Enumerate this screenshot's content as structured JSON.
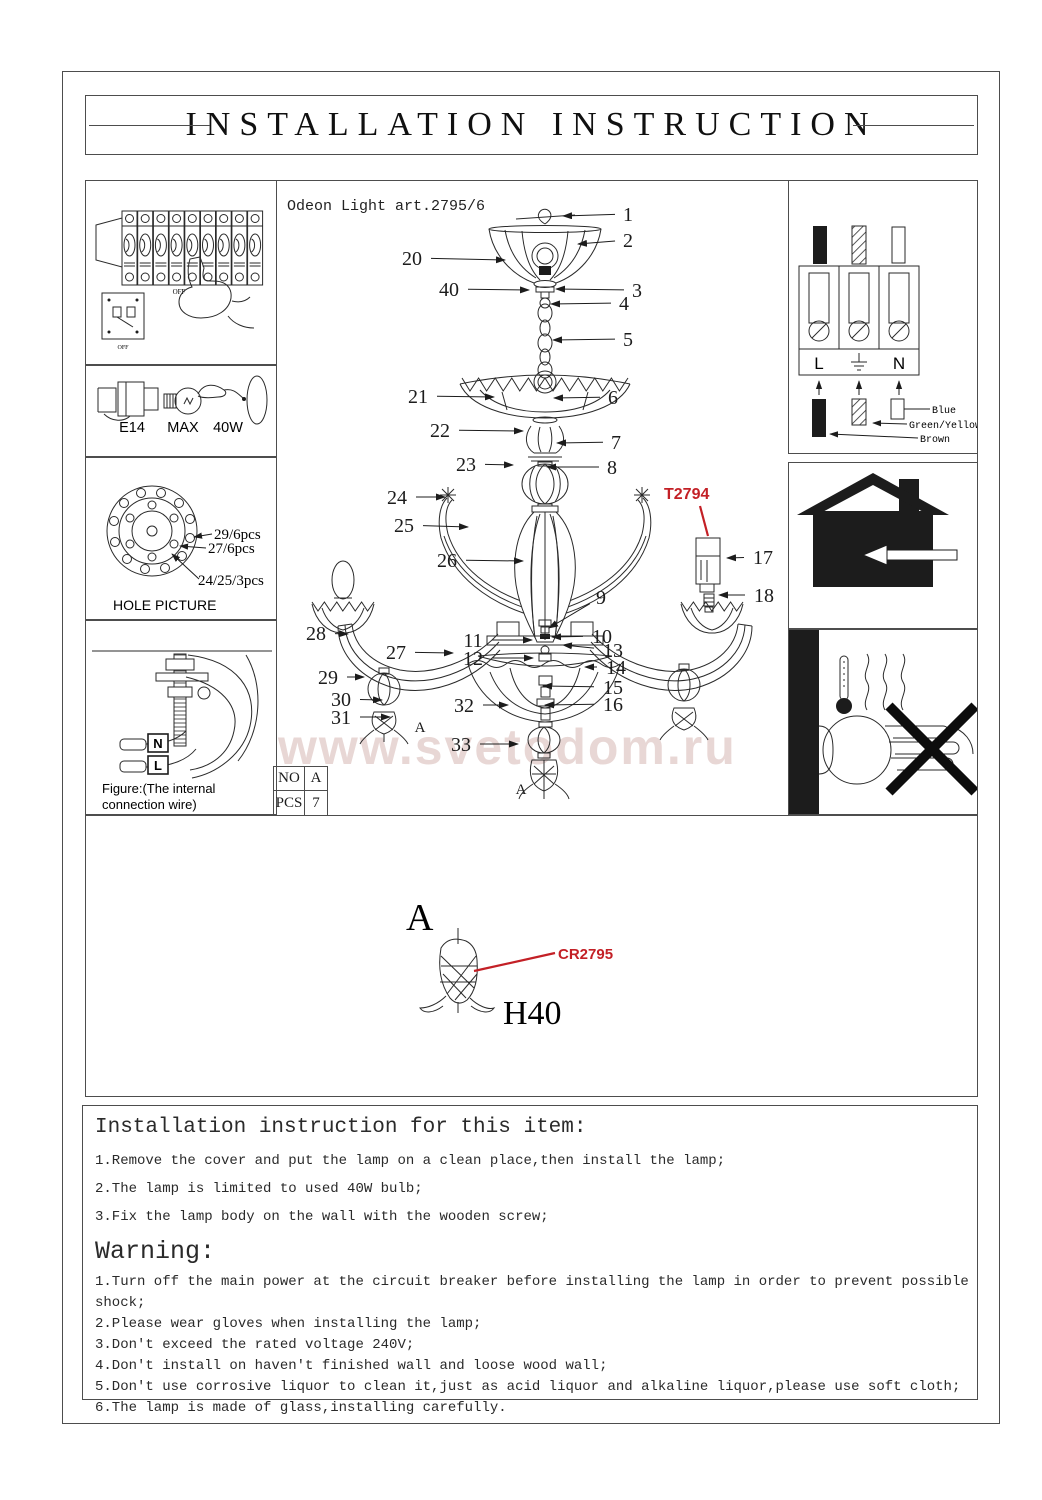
{
  "title": "INSTALLATION INSTRUCTION",
  "product_code": "Odeon Light art.2795/6",
  "watermark": "www.svetodom.ru",
  "colors": {
    "accent_red": "#c32026",
    "watermark_pink": "#e8d7d5"
  },
  "left_panels": {
    "breaker": {
      "off_top": "OFF",
      "off_bottom": "OFF"
    },
    "bulb": {
      "socket": "E14",
      "max_label": "MAX",
      "wattage": "40W"
    },
    "hole": {
      "title": "HOLE PICTURE",
      "callouts": [
        "29/6pcs",
        "27/6pcs",
        "24/25/3pcs"
      ]
    },
    "wire": {
      "n_label": "N",
      "l_label": "L",
      "caption_line1": "Figure:(The internal",
      "caption_line2": "connection wire)"
    }
  },
  "right_panels": {
    "terminal": {
      "live": "L",
      "neutral": "N",
      "wire_labels": [
        "Blue",
        "Green/Yellow",
        "Brown"
      ]
    }
  },
  "diagram": {
    "red_code": "T2794",
    "table": {
      "r1c1": "NO",
      "r1c2": "A",
      "r2c1": "PCS",
      "r2c2": "7"
    },
    "tag_left_arm": "A",
    "tag_bottom": "A",
    "detail": {
      "letter": "A",
      "code": "CR2795",
      "size": "H40"
    },
    "part_labels": [
      {
        "t": "1",
        "lx": 628,
        "ly": 214,
        "tx": 563,
        "ty": 216
      },
      {
        "t": "2",
        "lx": 628,
        "ly": 240,
        "tx": 578,
        "ty": 244
      },
      {
        "t": "20",
        "lx": 412,
        "ly": 258,
        "tx": 505,
        "ty": 260
      },
      {
        "t": "40",
        "lx": 449,
        "ly": 289,
        "tx": 529,
        "ty": 290
      },
      {
        "t": "3",
        "lx": 637,
        "ly": 290,
        "tx": 556,
        "ty": 289
      },
      {
        "t": "4",
        "lx": 624,
        "ly": 303,
        "tx": 551,
        "ty": 304
      },
      {
        "t": "5",
        "lx": 628,
        "ly": 339,
        "tx": 553,
        "ty": 340
      },
      {
        "t": "21",
        "lx": 418,
        "ly": 396,
        "tx": 494,
        "ty": 397
      },
      {
        "t": "6",
        "lx": 613,
        "ly": 397,
        "tx": 554,
        "ty": 398
      },
      {
        "t": "22",
        "lx": 440,
        "ly": 430,
        "tx": 523,
        "ty": 431
      },
      {
        "t": "7",
        "lx": 616,
        "ly": 442,
        "tx": 557,
        "ty": 443
      },
      {
        "t": "23",
        "lx": 466,
        "ly": 464,
        "tx": 513,
        "ty": 465
      },
      {
        "t": "8",
        "lx": 612,
        "ly": 467,
        "tx": 547,
        "ty": 467
      },
      {
        "t": "24",
        "lx": 397,
        "ly": 497,
        "tx": 445,
        "ty": 497
      },
      {
        "t": "25",
        "lx": 404,
        "ly": 525,
        "tx": 468,
        "ty": 527
      },
      {
        "t": "26",
        "lx": 447,
        "ly": 560,
        "tx": 523,
        "ty": 561
      },
      {
        "t": "17",
        "lx": 763,
        "ly": 557,
        "tx": 727,
        "ty": 558
      },
      {
        "t": "18",
        "lx": 764,
        "ly": 595,
        "tx": 719,
        "ty": 595
      },
      {
        "t": "9",
        "lx": 601,
        "ly": 597,
        "tx": 549,
        "ty": 628
      },
      {
        "t": "28",
        "lx": 316,
        "ly": 633,
        "tx": 348,
        "ty": 634
      },
      {
        "t": "10",
        "lx": 602,
        "ly": 636,
        "tx": 552,
        "ty": 637
      },
      {
        "t": "11",
        "lx": 473,
        "ly": 640,
        "tx": 532,
        "ty": 640
      },
      {
        "t": "13",
        "lx": 613,
        "ly": 650,
        "tx": 563,
        "ty": 645
      },
      {
        "t": "27",
        "lx": 396,
        "ly": 652,
        "tx": 453,
        "ty": 653
      },
      {
        "t": "12",
        "lx": 473,
        "ly": 658,
        "tx": 533,
        "ty": 658
      },
      {
        "t": "14",
        "lx": 616,
        "ly": 667,
        "tx": 585,
        "ty": 667
      },
      {
        "t": "29",
        "lx": 328,
        "ly": 677,
        "tx": 364,
        "ty": 677
      },
      {
        "t": "15",
        "lx": 613,
        "ly": 687,
        "tx": 543,
        "ty": 686
      },
      {
        "t": "30",
        "lx": 341,
        "ly": 699,
        "tx": 382,
        "ty": 700
      },
      {
        "t": "32",
        "lx": 464,
        "ly": 705,
        "tx": 508,
        "ty": 705
      },
      {
        "t": "16",
        "lx": 613,
        "ly": 704,
        "tx": 545,
        "ty": 705
      },
      {
        "t": "31",
        "lx": 341,
        "ly": 717,
        "tx": 390,
        "ty": 717
      },
      {
        "t": "33",
        "lx": 461,
        "ly": 744,
        "tx": 518,
        "ty": 744
      }
    ]
  },
  "instructions": {
    "heading": "Installation instruction for this item:",
    "items": [
      "1.Remove the cover and put the lamp on a clean place,then install the lamp;",
      "2.The lamp is limited to used 40W bulb;",
      "3.Fix the lamp body on the wall with the wooden screw;"
    ],
    "warning_heading": "Warning:",
    "warning_items": [
      "1.Turn off the main power at the circuit breaker before installing the lamp in order to prevent possible shock;",
      "2.Please wear gloves when installing the lamp;",
      "3.Don't exceed the rated voltage 240V;",
      "4.Don't install on haven't finished wall and loose wood wall;",
      "5.Don't use corrosive liquor to clean it,just as acid liquor and alkaline liquor,please use soft cloth;",
      "6.The lamp is made of glass,installing carefully."
    ]
  }
}
